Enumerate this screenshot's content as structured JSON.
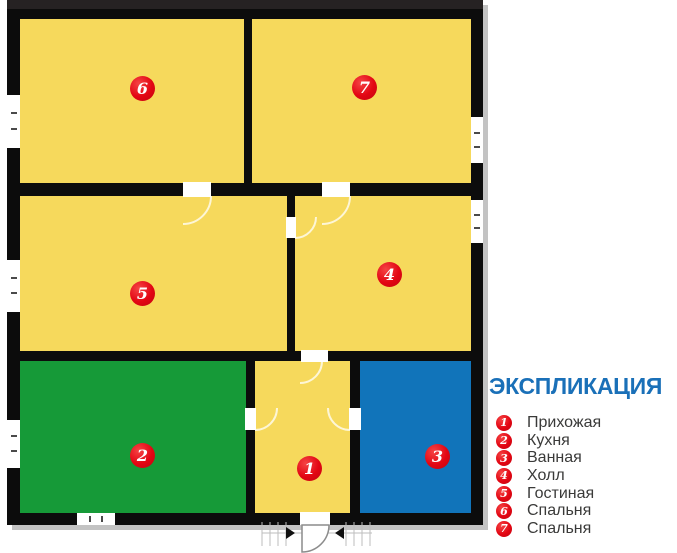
{
  "legend": {
    "title": "ЭКСПЛИКАЦИЯ",
    "items": [
      {
        "number": "1",
        "label": "Прихожая"
      },
      {
        "number": "2",
        "label": "Кухня"
      },
      {
        "number": "3",
        "label": "Ванная"
      },
      {
        "number": "4",
        "label": "Холл"
      },
      {
        "number": "5",
        "label": "Гостиная"
      },
      {
        "number": "6",
        "label": "Спальня"
      },
      {
        "number": "7",
        "label": "Спальня"
      }
    ]
  },
  "plan": {
    "rooms": [
      {
        "number": "1",
        "name": "Прихожая",
        "fill": "#f6d95c"
      },
      {
        "number": "2",
        "name": "Кухня",
        "fill": "#169a38"
      },
      {
        "number": "3",
        "name": "Ванная",
        "fill": "#1174ba"
      },
      {
        "number": "4",
        "name": "Холл",
        "fill": "#f6d95c"
      },
      {
        "number": "5",
        "name": "Гостиная",
        "fill": "#f6d95c"
      },
      {
        "number": "6",
        "name": "Спальня",
        "fill": "#f6d95c"
      },
      {
        "number": "7",
        "name": "Спальня",
        "fill": "#f6d95c"
      }
    ]
  },
  "colors": {
    "wall": "#0c0c0c",
    "room_yellow": "#f6d95c",
    "room_green": "#169a38",
    "room_blue": "#1174ba",
    "badge_red": "#e30613",
    "title_blue": "#1a70b8",
    "legend_text": "#3a3a39"
  }
}
